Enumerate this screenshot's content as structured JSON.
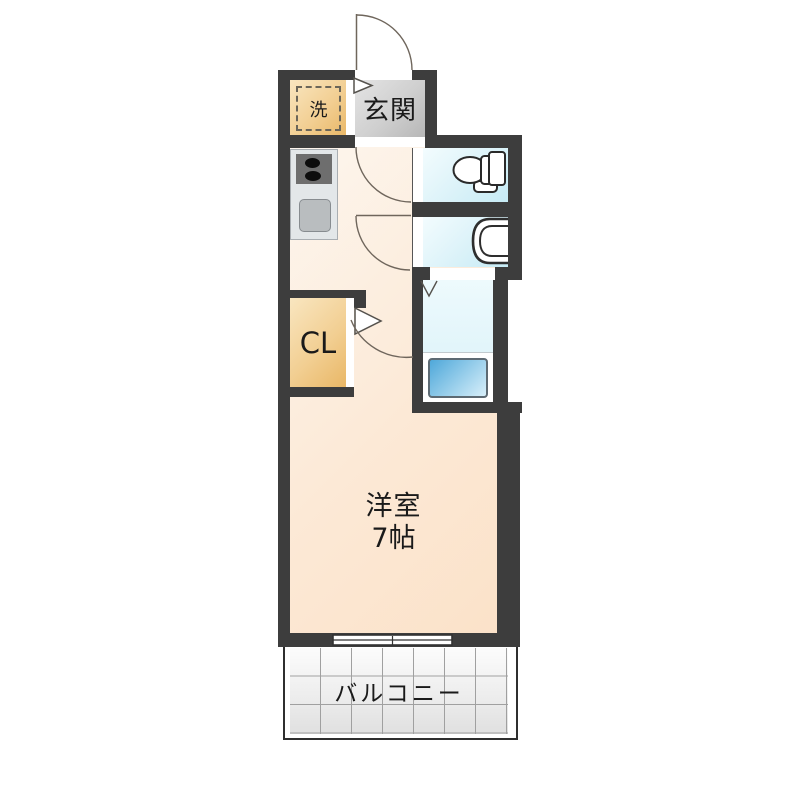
{
  "floorplan": {
    "kind": "japanese-apartment-floor-plan",
    "labels": {
      "entrance": "玄関",
      "laundry": "洗",
      "closet": "CL",
      "main_room_name": "洋室",
      "main_room_size": "7帖",
      "balcony": "バルコニー"
    },
    "fixtures": [
      "entrance-door-swing-arc",
      "entrance-step-marker",
      "washing-machine-space",
      "stove-icon",
      "sink-icon",
      "toilet-icon",
      "washbasin-icon",
      "bathtub-icon",
      "folding-door-marker",
      "hall-door-swing-arcs",
      "main-room-door-swing-arc",
      "sliding-window",
      "balcony-tile-grid"
    ],
    "colors": {
      "wall": "#3d3d3d",
      "floor_peach_light": "#fdf6ee",
      "floor_peach_dark": "#fbe2c9",
      "entrance_gray_light": "#e4e4e4",
      "entrance_gray_dark": "#b7b7b7",
      "storage_tan_light": "#f9e6c0",
      "storage_tan_dark": "#e9b766",
      "wet_area_light": "#f3fcfe",
      "wet_area_dark": "#c6ebf5",
      "bathtub_blue": "#4fa8da",
      "balcony_tile_line": "#a0a0a0"
    }
  }
}
